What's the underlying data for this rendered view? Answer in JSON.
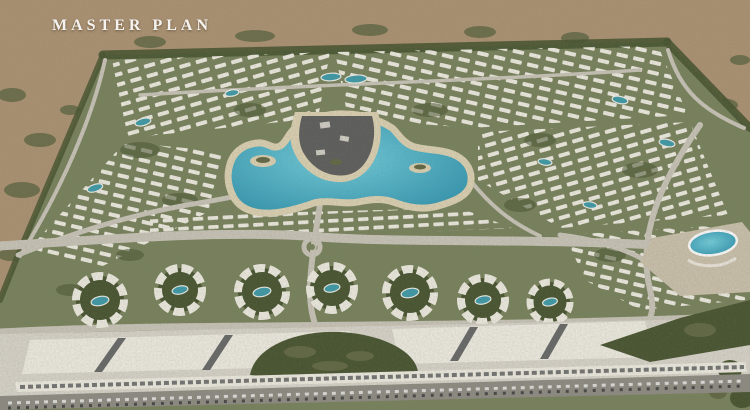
{
  "overlay": {
    "title": "MASTER PLAN"
  },
  "scene": {
    "description": "Aerial 3D render of a desert master-planned residential compound with a large turquoise central lagoon, curved white apartment clusters with courtyard pools, landscaped greenery, a commercial strip and a front road with parked cars."
  },
  "colors": {
    "desert": "#ab9172",
    "shrub": "#5e6642",
    "green": "#76815b",
    "greenDark": "#44522e",
    "lagoon": "#45b4cc",
    "lagoonDeep": "#2e97b4",
    "poolTeal": "#3a9aaa",
    "sand": "#dcd2b4",
    "building": "#efede4",
    "buildingDark": "#4b4f52",
    "beige": "#cbc2ae",
    "plaza": "#d8d5cc",
    "road": "#c9c5ba",
    "roadDark": "#8d8b84"
  }
}
